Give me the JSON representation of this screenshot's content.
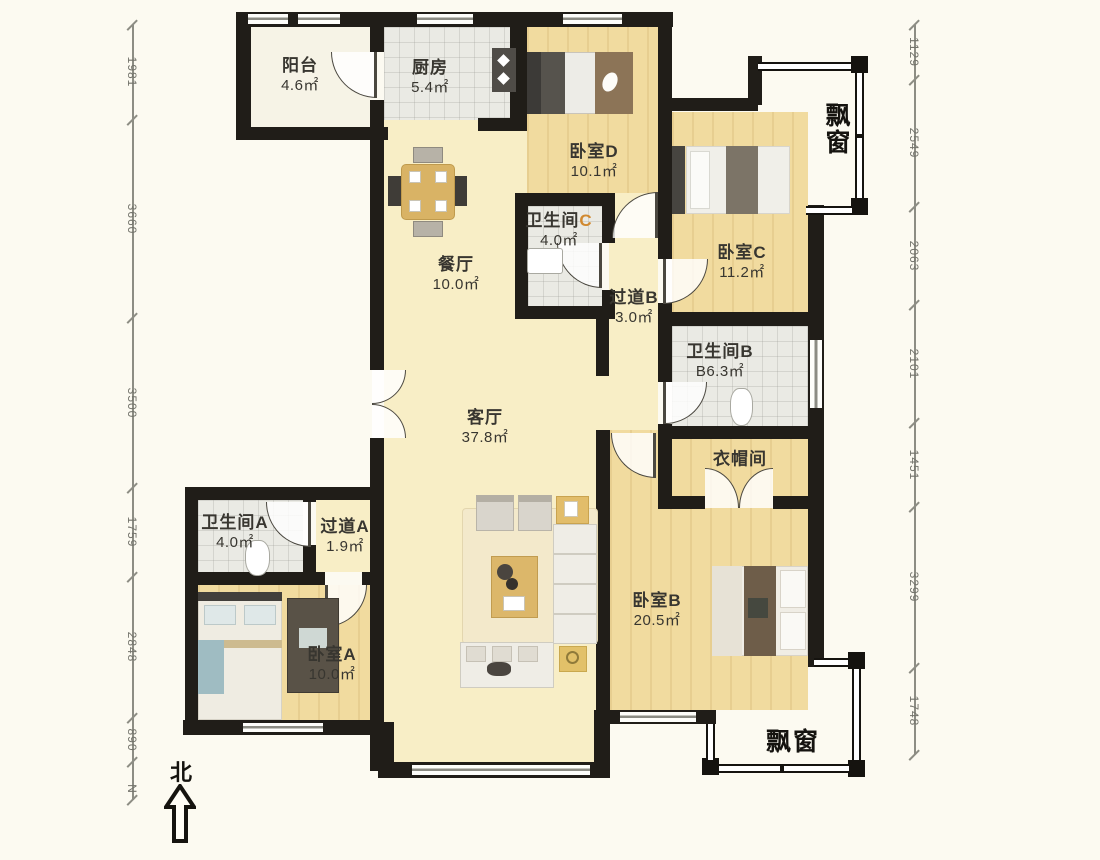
{
  "plan": {
    "rooms": [
      {
        "name": "阳台",
        "area": "4.6㎡"
      },
      {
        "name": "厨房",
        "area": "5.4㎡"
      },
      {
        "name": "卧室D",
        "area": "10.1㎡"
      },
      {
        "name": "卫生间",
        "suffix": "C",
        "area": "4.0㎡"
      },
      {
        "name": "过道B",
        "area": "3.0㎡"
      },
      {
        "name": "餐厅",
        "area": "10.0㎡"
      },
      {
        "name": "卧室C",
        "area": "11.2㎡"
      },
      {
        "name": "卫生间B",
        "area": "B6.3㎡"
      },
      {
        "name": "衣帽间",
        "area": ""
      },
      {
        "name": "客厅",
        "area": "37.8㎡"
      },
      {
        "name": "卫生间A",
        "area": "4.0㎡"
      },
      {
        "name": "过道A",
        "area": "1.9㎡"
      },
      {
        "name": "卧室A",
        "area": "10.0㎡"
      },
      {
        "name": "卧室B",
        "area": "20.5㎡"
      }
    ],
    "bay_window_label": "飘窗",
    "north_label": "北",
    "compass_n": "N",
    "dims_left": [
      "1981",
      "3660",
      "3500",
      "1759",
      "2848",
      "890"
    ],
    "dims_right": [
      "1129",
      "2549",
      "2063",
      "2101",
      "1451",
      "3299",
      "1748"
    ],
    "colors": {
      "wall": "#201d18",
      "wood": "#f1db9f",
      "cream": "#f8eec6",
      "tile": "#eaeae4",
      "accent_suffix": "#d1892f"
    }
  }
}
